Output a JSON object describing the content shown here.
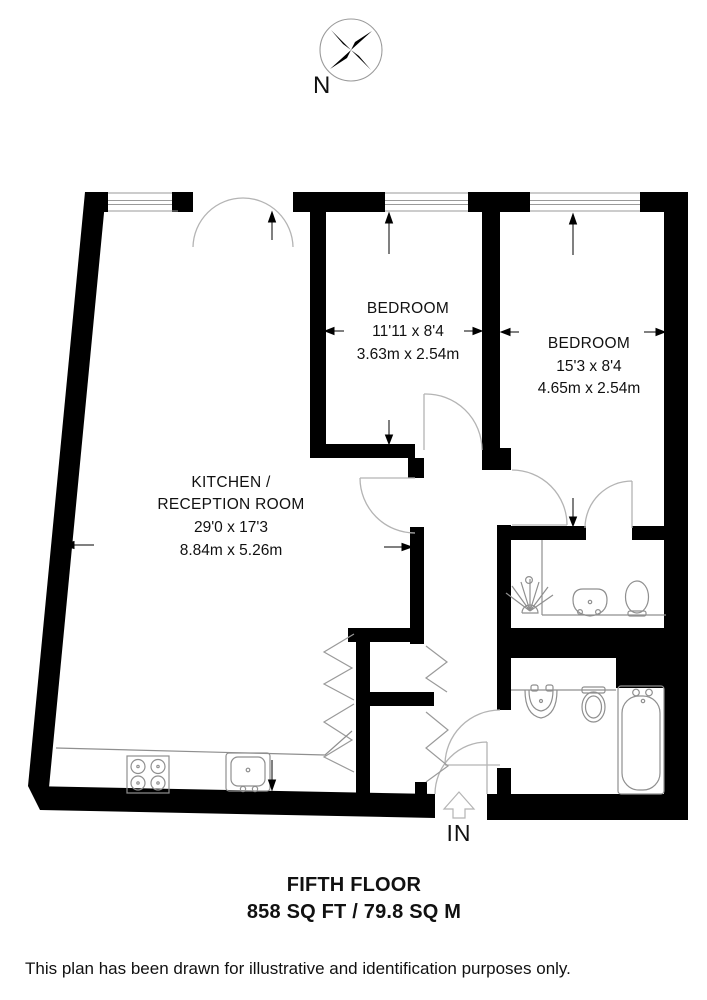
{
  "compass": {
    "north_label": "N"
  },
  "rooms": {
    "bedroom1": {
      "name": "BEDROOM",
      "imperial": "11'11 x 8'4",
      "metric": "3.63m x 2.54m"
    },
    "bedroom2": {
      "name": "BEDROOM",
      "imperial": "15'3 x 8'4",
      "metric": "4.65m x 2.54m"
    },
    "kitchen": {
      "name_line1": "KITCHEN /",
      "name_line2": "RECEPTION ROOM",
      "imperial": "29'0 x 17'3",
      "metric": "8.84m x 5.26m"
    }
  },
  "entrance": {
    "label": "IN"
  },
  "footer": {
    "floor_label": "FIFTH FLOOR",
    "area_label": "858 SQ FT / 79.8 SQ M"
  },
  "disclaimer": "This plan has been drawn for illustrative and identification purposes only.",
  "colors": {
    "walls": "#000000",
    "fixtures": "#8f8f8f",
    "doors": "#b4b4b4",
    "glazing": "#9a9a9a",
    "arrows": "#000000"
  }
}
